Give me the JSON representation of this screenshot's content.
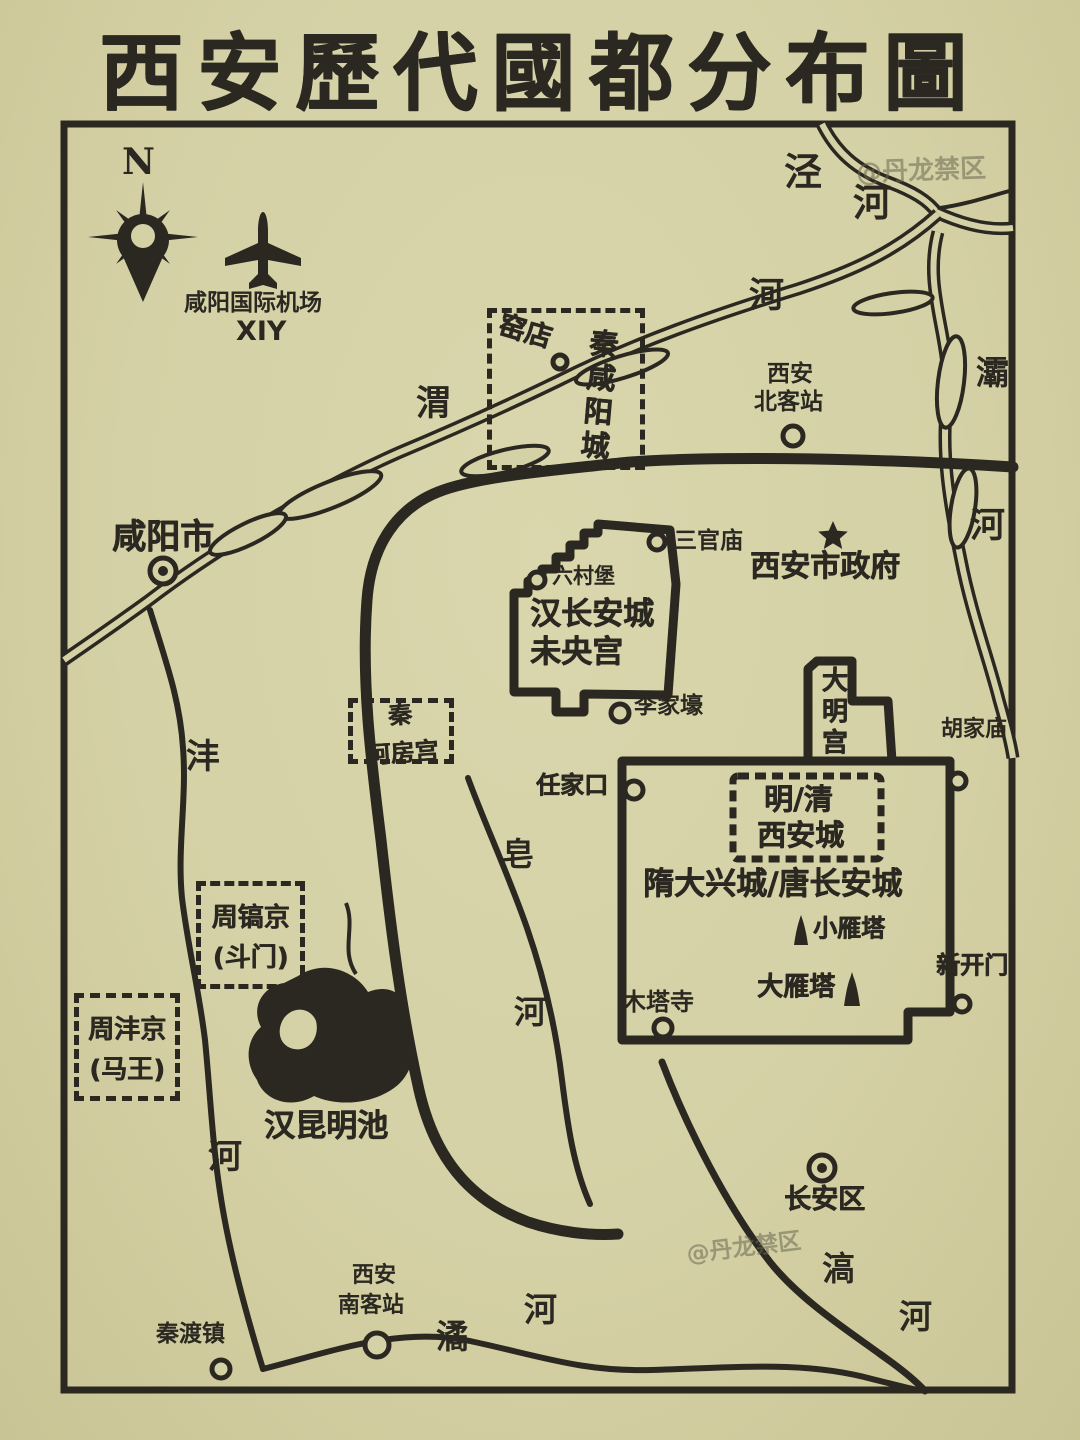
{
  "title": "西安歷代國都分布圖",
  "compass": {
    "north": "N"
  },
  "airport": {
    "name": "咸阳国际机场",
    "code": "XIY"
  },
  "watermark": {
    "top_right": "@丹龙禁区",
    "bottom": "@丹龙禁区"
  },
  "colors": {
    "background": "#d5d1a6",
    "ink": "#2a2820"
  },
  "rivers": {
    "jing": {
      "char1": "泾",
      "char2": "河"
    },
    "wei": {
      "char1": "渭",
      "char2": "河"
    },
    "ba": {
      "char1": "灞",
      "char2": "河"
    },
    "feng": {
      "char1": "沣",
      "char2": "河"
    },
    "zao": {
      "char1": "皂",
      "char2": "河"
    },
    "jue": {
      "char1": "潏",
      "char2": "河"
    },
    "hao": {
      "char1": "滈",
      "char2": "河"
    }
  },
  "capitals": {
    "qin_xianyang": {
      "site": "窑店",
      "name": "秦咸阳城"
    },
    "qin_epang": {
      "line1": "秦",
      "line2": "阿房宫"
    },
    "han_changan": {
      "line1": "汉长安城",
      "line2": "未央宫"
    },
    "daming": {
      "name": "大明宫"
    },
    "ming_qing": {
      "line1": "明/清",
      "line2": "西安城"
    },
    "sui_tang": {
      "name": "隋大兴城/唐长安城"
    },
    "zhou_hao": {
      "line1": "周镐京",
      "line2": "(斗门)"
    },
    "zhou_feng": {
      "line1": "周沣京",
      "line2": "(马王)"
    }
  },
  "places": {
    "xianyang_city": "咸阳市",
    "gov": "西安市政府",
    "north_station1": "西安",
    "north_station2": "北客站",
    "south_station1": "西安",
    "south_station2": "南客站",
    "sanguanmiao": "三官庙",
    "liucunbu": "六村堡",
    "lijiahao": "李家壕",
    "renjiakou": "任家口",
    "hujiamiao": "胡家庙",
    "xiaoyanta": "小雁塔",
    "dayanta": "大雁塔",
    "xinkaimen": "新开门",
    "mutasi": "木塔寺",
    "kunming": "汉昆明池",
    "changan_district": "长安区",
    "qindu": "秦渡镇"
  }
}
